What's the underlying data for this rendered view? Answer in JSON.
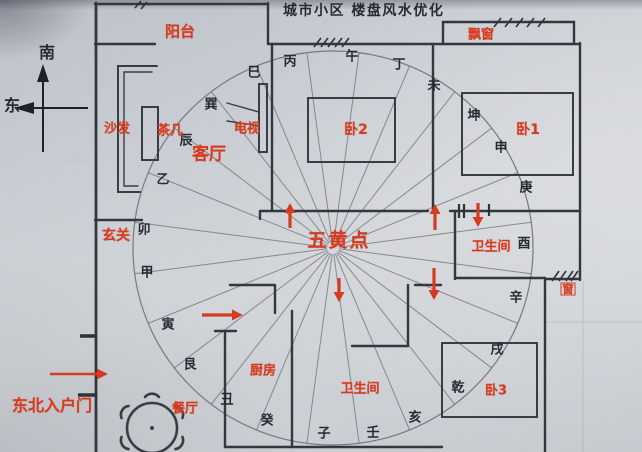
{
  "title": "城市小区 楼盘风水优化",
  "compass": {
    "south": "南",
    "east": "东"
  },
  "center_label": {
    "text": "五黄点",
    "x": 339,
    "y": 241
  },
  "ring": {
    "cx": 333,
    "cy": 248,
    "rx": 200,
    "ry": 197,
    "sectors": 24,
    "labels": [
      {
        "t": "午",
        "x": 352,
        "y": 57
      },
      {
        "t": "丁",
        "x": 399,
        "y": 65
      },
      {
        "t": "未",
        "x": 434,
        "y": 86
      },
      {
        "t": "坤",
        "x": 474,
        "y": 116
      },
      {
        "t": "申",
        "x": 501,
        "y": 148
      },
      {
        "t": "庚",
        "x": 526,
        "y": 188
      },
      {
        "t": "酉",
        "x": 524,
        "y": 244
      },
      {
        "t": "辛",
        "x": 516,
        "y": 298
      },
      {
        "t": "戌",
        "x": 497,
        "y": 350
      },
      {
        "t": "乾",
        "x": 458,
        "y": 388
      },
      {
        "t": "亥",
        "x": 415,
        "y": 418
      },
      {
        "t": "壬",
        "x": 373,
        "y": 433
      },
      {
        "t": "子",
        "x": 324,
        "y": 434
      },
      {
        "t": "癸",
        "x": 267,
        "y": 421
      },
      {
        "t": "丑",
        "x": 227,
        "y": 400
      },
      {
        "t": "艮",
        "x": 190,
        "y": 365
      },
      {
        "t": "寅",
        "x": 168,
        "y": 325
      },
      {
        "t": "甲",
        "x": 147,
        "y": 273
      },
      {
        "t": "卯",
        "x": 144,
        "y": 230
      },
      {
        "t": "乙",
        "x": 163,
        "y": 180
      },
      {
        "t": "辰",
        "x": 186,
        "y": 141
      },
      {
        "t": "巽",
        "x": 211,
        "y": 105
      },
      {
        "t": "巳",
        "x": 254,
        "y": 73
      },
      {
        "t": "丙",
        "x": 290,
        "y": 62
      }
    ]
  },
  "rooms": [
    {
      "id": "balcony",
      "label": "阳台",
      "x": 180,
      "y": 32,
      "size": 15
    },
    {
      "id": "bay-window",
      "label": "飘窗",
      "x": 481,
      "y": 35,
      "size": 13
    },
    {
      "id": "sofa",
      "label": "沙发",
      "x": 117,
      "y": 129,
      "size": 13
    },
    {
      "id": "tea-table",
      "label": "茶几",
      "x": 170,
      "y": 131,
      "size": 13
    },
    {
      "id": "tv",
      "label": "电视",
      "x": 247,
      "y": 129,
      "size": 13
    },
    {
      "id": "living-room",
      "label": "客厅",
      "x": 209,
      "y": 155,
      "size": 17
    },
    {
      "id": "entry-hall",
      "label": "玄关",
      "x": 116,
      "y": 236,
      "size": 14
    },
    {
      "id": "bedroom-2",
      "label": "卧2",
      "x": 356,
      "y": 130,
      "size": 14
    },
    {
      "id": "bedroom-1",
      "label": "卧1",
      "x": 528,
      "y": 130,
      "size": 14
    },
    {
      "id": "bathroom-east",
      "label": "卫生间",
      "x": 491,
      "y": 247,
      "size": 13
    },
    {
      "id": "window-east",
      "label": "窗",
      "x": 568,
      "y": 289,
      "size": 11
    },
    {
      "id": "bedroom-3",
      "label": "卧3",
      "x": 496,
      "y": 391,
      "size": 13
    },
    {
      "id": "kitchen",
      "label": "厨房",
      "x": 263,
      "y": 371,
      "size": 13
    },
    {
      "id": "bathroom-south",
      "label": "卫生间",
      "x": 360,
      "y": 389,
      "size": 13
    },
    {
      "id": "dining-room",
      "label": "餐厅",
      "x": 185,
      "y": 409,
      "size": 13
    },
    {
      "id": "entrance-door",
      "label": "东北入户门",
      "x": 52,
      "y": 406,
      "size": 16
    }
  ],
  "arrows": [
    {
      "id": "arrow-up-center",
      "dir": "up",
      "x": 290,
      "from": 228,
      "to": 203
    },
    {
      "id": "arrow-up-hall",
      "dir": "up",
      "x": 435,
      "from": 230,
      "to": 204
    },
    {
      "id": "arrow-down-bathroom",
      "dir": "down",
      "x": 478,
      "from": 203,
      "to": 227
    },
    {
      "id": "arrow-down-mid",
      "dir": "down",
      "x": 339,
      "from": 278,
      "to": 302
    },
    {
      "id": "arrow-down-corridor",
      "dir": "down",
      "x": 434,
      "from": 268,
      "to": 300
    },
    {
      "id": "arrow-right-kitchen",
      "dir": "right",
      "y": 315,
      "from": 202,
      "to": 243
    },
    {
      "id": "arrow-right-entrance",
      "dir": "right",
      "y": 374,
      "from": 50,
      "to": 108
    }
  ],
  "colors": {
    "marker_red": "#d63a1f",
    "wall_ink": "#33373e",
    "ray_gray": "#6b7078"
  }
}
